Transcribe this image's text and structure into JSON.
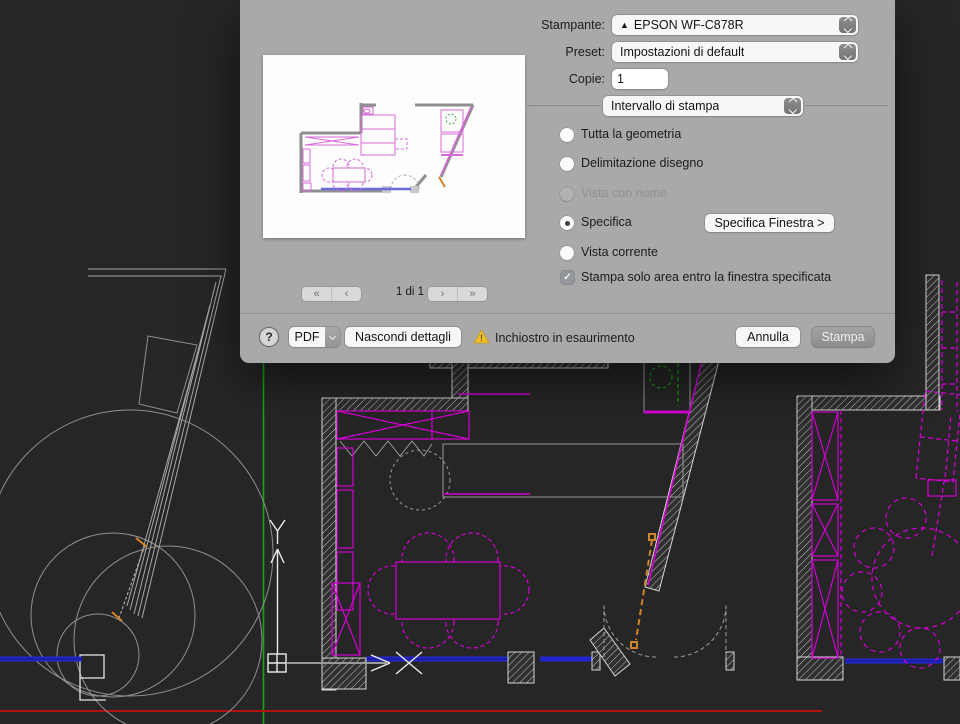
{
  "dialog": {
    "printer": {
      "label": "Stampante:",
      "value": "EPSON WF-C878R",
      "warning_glyph": "▲"
    },
    "preset": {
      "label": "Preset:",
      "value": "Impostazioni di default"
    },
    "copies": {
      "label": "Copie:",
      "value": "1"
    },
    "range_select": "Intervallo di stampa",
    "radios": [
      {
        "label": "Tutta la geometria",
        "state": "normal"
      },
      {
        "label": "Delimitazione disegno",
        "state": "normal"
      },
      {
        "label": "Vista con nome",
        "state": "disabled"
      },
      {
        "label": "Specifica",
        "state": "selected"
      },
      {
        "label": "Vista corrente",
        "state": "normal"
      }
    ],
    "specify_window_button": "Specifica Finestra >",
    "checkbox_label": "Stampa solo area entro la finestra specificata",
    "checkbox_checked": true,
    "pager": {
      "first": "«",
      "prev": "‹",
      "page": "1 di 1",
      "next": "›",
      "last": "»"
    },
    "footer": {
      "help": "?",
      "pdf": "PDF",
      "hide_details": "Nascondi dettagli",
      "ink_warning": "Inchiostro in esaurimento",
      "cancel": "Annulla",
      "print": "Stampa"
    }
  },
  "colors": {
    "dialog_bg": "#a9a9a9",
    "canvas_bg": "#262626",
    "cad_magenta": "#d400d4",
    "cad_blue": "#2525cf",
    "cad_green": "#17a617",
    "cad_red": "#b41111",
    "cad_orange": "#d2842a",
    "warning_yellow": "#edc02c"
  }
}
